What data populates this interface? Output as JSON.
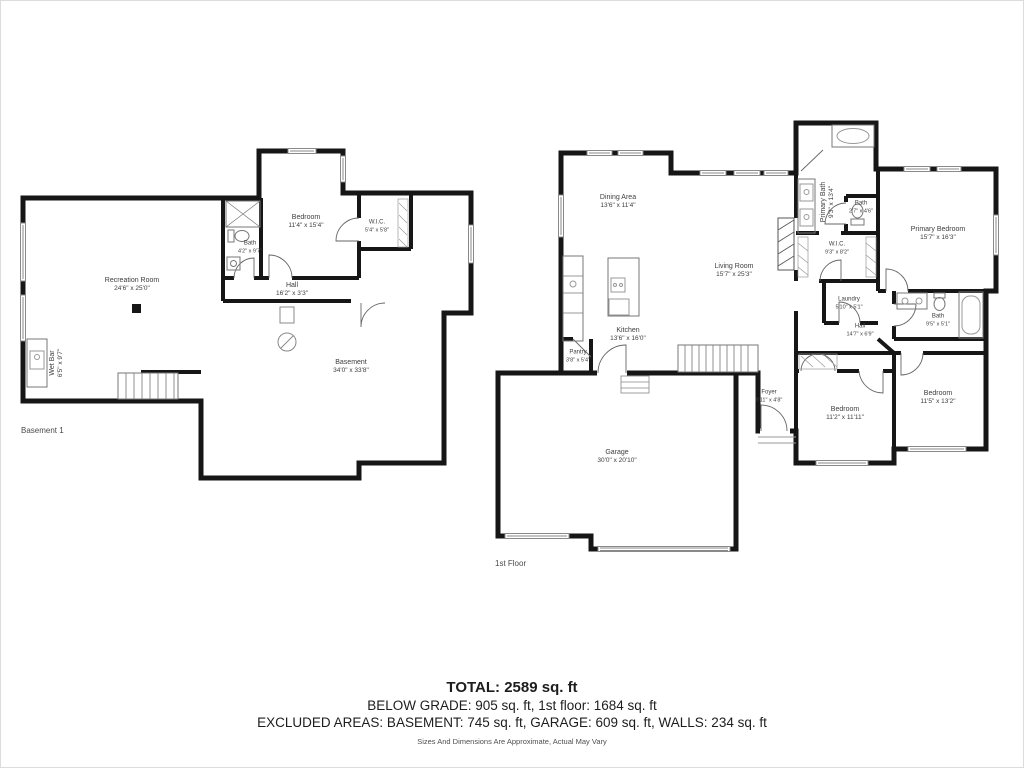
{
  "colors": {
    "wall": "#161616",
    "thin_line": "#777777",
    "window_line": "#8a8a8a",
    "label_text": "#3d3d3d"
  },
  "basement": {
    "title": "Basement 1",
    "rooms": {
      "recreation_room": {
        "name": "Recreation Room",
        "dims": "24'6\" x 25'0\""
      },
      "bedroom": {
        "name": "Bedroom",
        "dims": "11'4\" x 15'4\""
      },
      "bath": {
        "name": "Bath",
        "dims": "4'2\" x 9'7\""
      },
      "wic": {
        "name": "W.I.C.",
        "dims": "5'4\" x 5'8\""
      },
      "hall": {
        "name": "Hall",
        "dims": "16'2\" x 3'3\""
      },
      "wet_bar": {
        "name": "Wet Bar",
        "dims": "6'5\" x 9'7\""
      },
      "basement_room": {
        "name": "Basement",
        "dims": "34'0\" x 33'8\""
      }
    }
  },
  "first_floor": {
    "title": "1st Floor",
    "rooms": {
      "dining_area": {
        "name": "Dining Area",
        "dims": "13'6\" x 11'4\""
      },
      "living_room": {
        "name": "Living Room",
        "dims": "15'7\" x 25'3\""
      },
      "kitchen": {
        "name": "Kitchen",
        "dims": "13'6\" x 16'0\""
      },
      "pantry": {
        "name": "Pantry",
        "dims": "3'8\" x 5'4\""
      },
      "garage": {
        "name": "Garage",
        "dims": "30'0\" x 20'10\""
      },
      "foyer": {
        "name": "Foyer",
        "dims": "9'11\" x 4'8\""
      },
      "primary_bath": {
        "name": "Primary Bath",
        "dims": "9'3\" x 13'4\""
      },
      "bath_small": {
        "name": "Bath",
        "dims": "2'7\" x 4'6\""
      },
      "wic": {
        "name": "W.I.C.",
        "dims": "9'3\" x 8'2\""
      },
      "laundry": {
        "name": "Laundry",
        "dims": "5'10\" x 5'1\""
      },
      "hall": {
        "name": "Hall",
        "dims": "14'7\" x 6'9\""
      },
      "primary_bedroom": {
        "name": "Primary Bedroom",
        "dims": "15'7\" x 16'3\""
      },
      "bath": {
        "name": "Bath",
        "dims": "9'5\" x 5'1\""
      },
      "bedroom_1": {
        "name": "Bedroom",
        "dims": "11'2\" x 11'11\""
      },
      "bedroom_2": {
        "name": "Bedroom",
        "dims": "11'5\" x 13'2\""
      }
    }
  },
  "summary": {
    "total": "TOTAL: 2589 sq. ft",
    "grade_line": "BELOW GRADE: 905 sq. ft, 1st floor: 1684 sq. ft",
    "excluded_line": "EXCLUDED AREAS: BASEMENT: 745 sq. ft, GARAGE: 609 sq. ft, WALLS: 234 sq. ft",
    "disclaimer": "Sizes And Dimensions Are Approximate, Actual May Vary"
  }
}
